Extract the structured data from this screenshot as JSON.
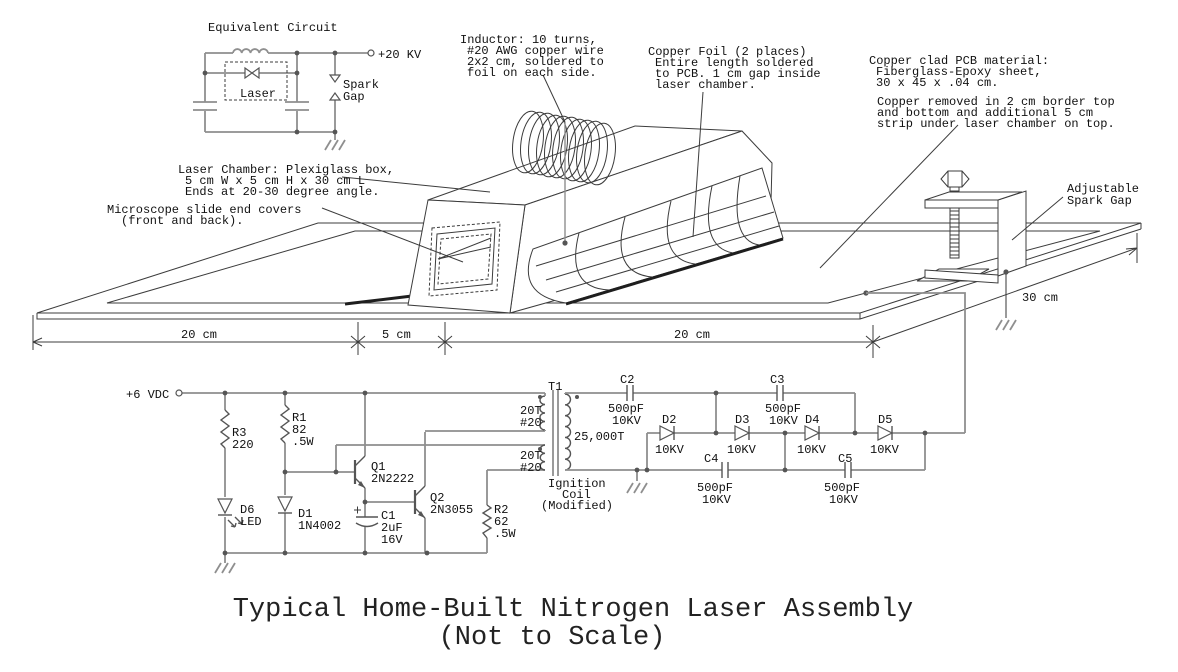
{
  "title": {
    "main": "Typical Home-Built Nitrogen Laser Assembly",
    "sub": "(Not to Scale)"
  },
  "equivalent_circuit": {
    "heading": "Equivalent Circuit",
    "hv_terminal": "+20 KV",
    "spark_gap": [
      "Spark",
      "Gap"
    ],
    "laser": "Laser"
  },
  "annotations": {
    "inductor": [
      "Inductor: 10 turns,",
      "#20 AWG copper wire",
      "2x2 cm, soldered to",
      "foil on each side."
    ],
    "copper_foil": [
      "Copper Foil (2 places)",
      "Entire length soldered",
      "to PCB. 1 cm gap inside",
      "laser chamber."
    ],
    "pcb_material": [
      "Copper clad PCB material:",
      "Fiberglass-Epoxy sheet,",
      "30 x 45 x .04 cm."
    ],
    "copper_removed": [
      "Copper removed in 2 cm border top",
      "and bottom and additional 5 cm",
      "strip under laser chamber on top."
    ],
    "laser_chamber": [
      "Laser Chamber: Plexiglass box,",
      "5 cm W x 5 cm H x 30 cm L",
      "Ends at 20-30 degree angle."
    ],
    "microscope_slides": [
      "Microscope slide end covers",
      "(front and back)."
    ],
    "adjustable_spark_gap": [
      "Adjustable",
      "Spark Gap"
    ]
  },
  "dimensions": [
    "20 cm",
    "5 cm",
    "20 cm",
    "30 cm"
  ],
  "driver_circuit": {
    "supply": "+6 VDC",
    "r3": [
      "R3",
      "220"
    ],
    "r1": [
      "R1",
      "82",
      ".5W"
    ],
    "r2": [
      "R2",
      "62",
      ".5W"
    ],
    "d6": [
      "D6",
      "LED"
    ],
    "d1": [
      "D1",
      "1N4002"
    ],
    "q1": [
      "Q1",
      "2N2222"
    ],
    "q2": [
      "Q2",
      "2N3055"
    ],
    "c1": [
      "C1",
      "2uF",
      "16V"
    ],
    "transformer": {
      "name": "T1",
      "primary_top": [
        "20T",
        "#20"
      ],
      "primary_bottom": [
        "20T",
        "#20"
      ],
      "secondary": "25,000T",
      "note": [
        "Ignition",
        "Coil",
        "(Modified)"
      ]
    }
  },
  "multiplier_circuit": {
    "c2": [
      "C2",
      "500pF",
      "10KV"
    ],
    "c3": [
      "C3",
      "500pF",
      "10KV"
    ],
    "c4": [
      "C4",
      "500pF",
      "10KV"
    ],
    "c5": [
      "C5",
      "500pF",
      "10KV"
    ],
    "d2": [
      "D2",
      "10KV"
    ],
    "d3": [
      "D3",
      "10KV"
    ],
    "d4": [
      "D4",
      "10KV"
    ],
    "d5": [
      "D5",
      "10KV"
    ]
  }
}
